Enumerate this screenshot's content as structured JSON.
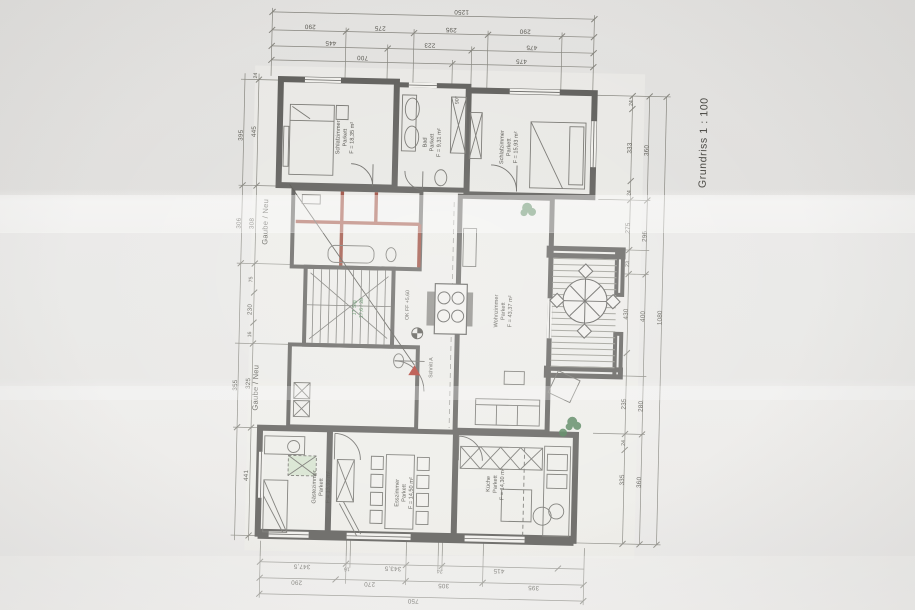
{
  "title": {
    "scale": "Grundriss 1 : 100"
  },
  "annotations": {
    "gaube_top": "Gaube / Neu",
    "gaube_bottom": "Gaube / Neu",
    "section": "Schnitt A",
    "level": "OK FF +5,60",
    "angle": "90°",
    "stairs_line1": "17 Stg",
    "stairs_line2": "17,6 / 28"
  },
  "rooms": {
    "schlafzimmer_links": {
      "name": "Schlafzimmer",
      "floor": "Parkett",
      "area": "F = 18,35 m²"
    },
    "bad": {
      "name": "Bad",
      "floor": "Parkett",
      "area": "F = 9,31 m²"
    },
    "schlafzimmer_rechts": {
      "name": "Schlafzimmer",
      "floor": "Parkett",
      "area": "F = 15,93 m²"
    },
    "wohnzimmer": {
      "name": "Wohnzimmer",
      "floor": "Parkett",
      "area": "F = 43,37 m²"
    },
    "esszimmer": {
      "name": "Esszimmer",
      "floor": "Parkett",
      "area": "F = 14,50 m²"
    },
    "kueche": {
      "name": "Küche",
      "floor": "Parkett",
      "area": "F = 14,30 m²"
    },
    "gaestezimmer": {
      "name": "Gästezimmer",
      "floor": "Parkett",
      "area": "F = 13,90 m²"
    }
  },
  "dimensions": {
    "top": {
      "total": "1250",
      "row2": [
        "290",
        "275",
        "295",
        "290"
      ],
      "row3": [
        "445",
        "223",
        "475"
      ],
      "row4": [
        "700",
        "475"
      ]
    },
    "bottom": {
      "row1": [
        "347,5",
        "16",
        "343,5",
        "24",
        "415"
      ],
      "row2": [
        "290",
        "270",
        "305",
        "395"
      ],
      "total": "750"
    },
    "left": {
      "inner": [
        "24",
        "445",
        "308",
        "75",
        "230",
        "16",
        "325",
        "441"
      ],
      "outer": [
        "395",
        "306",
        "355"
      ]
    },
    "right": {
      "inner": [
        "24",
        "333",
        "24",
        "275",
        "23",
        "430",
        "235",
        "24",
        "335"
      ],
      "mid": [
        "360",
        "296",
        "400",
        "280",
        "360"
      ],
      "total": "1080"
    }
  },
  "colors": {
    "paper": "#f1f0ec",
    "photo_background": "#e4e3e1",
    "wall": "#5f5e5b",
    "wall_new": "#9b4a3c",
    "dimension_line": "#85847d",
    "stair_note_green": "#3f7d4a",
    "skylight_green": "#d7e3d0",
    "section_marker_red": "#b03a2e"
  }
}
